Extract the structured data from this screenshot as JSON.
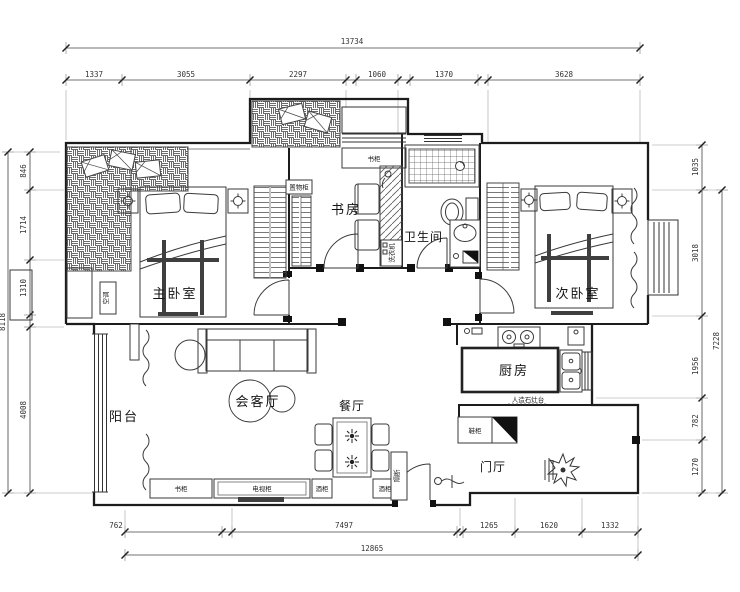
{
  "plan": {
    "rooms": {
      "master_bedroom": "主卧室",
      "second_bedroom": "次卧室",
      "study": "书房",
      "bathroom": "卫生间",
      "kitchen": "厨房",
      "dining": "餐厅",
      "living": "会客厅",
      "balcony": "阳台",
      "foyer": "门厅"
    },
    "furniture": {
      "storage_cabinet": "置物柜",
      "bookshelf": "书柜",
      "side_cabinet": "书柜",
      "tv_cabinet": "电视柜",
      "wine_cabinet_left": "酒柜",
      "wine_cabinet_right": "酒柜",
      "shoe_cabinet": "鞋柜",
      "washer": "洗衣机",
      "partition": "隔断",
      "counter": "人造石灶台",
      "ac": "空调"
    },
    "dims": {
      "top_total": "13734",
      "top": [
        "1337",
        "3055",
        "2297",
        "1060",
        "1370",
        "3628"
      ],
      "bottom": [
        "762",
        "7497",
        "1265",
        "1620",
        "1332"
      ],
      "bottom_total": "12865",
      "left": [
        "846",
        "1714",
        "1310",
        "4008"
      ],
      "left_total": "8118",
      "right": [
        "1035",
        "3018",
        "1956",
        "782",
        "1270"
      ],
      "right_total": "7228"
    }
  }
}
